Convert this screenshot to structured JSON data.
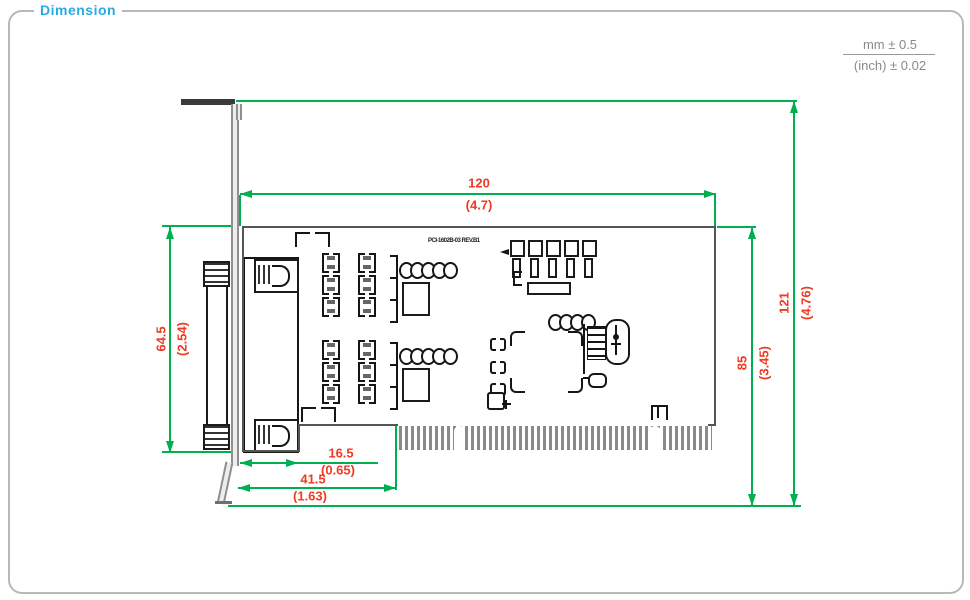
{
  "page": {
    "title": "Dimension"
  },
  "tolerance": {
    "mm": "mm ± 0.5",
    "inch": "(inch) ± 0.02"
  },
  "board": {
    "silkscreen_label": "PCI-1602B-03 REV.B1"
  },
  "dims": {
    "width": {
      "mm": "120",
      "inch": "(4.7)"
    },
    "bracket_height": {
      "mm": "64.5",
      "inch": "(2.54)"
    },
    "pcb_height": {
      "mm": "85",
      "inch": "(3.45)"
    },
    "overall_height": {
      "mm": "121",
      "inch": "(4.76)"
    },
    "connector_offset": {
      "mm": "16.5",
      "inch": "(0.65)"
    },
    "board_offset": {
      "mm": "41.5",
      "inch": "(1.63)"
    }
  },
  "colors": {
    "dimension_line": "#00b050",
    "dimension_text": "#ee3b22",
    "title_text": "#29abe2",
    "tolerance_text": "#8a8a8a",
    "pcb_outline": "#555555",
    "component_outline": "#1b1b1b"
  }
}
